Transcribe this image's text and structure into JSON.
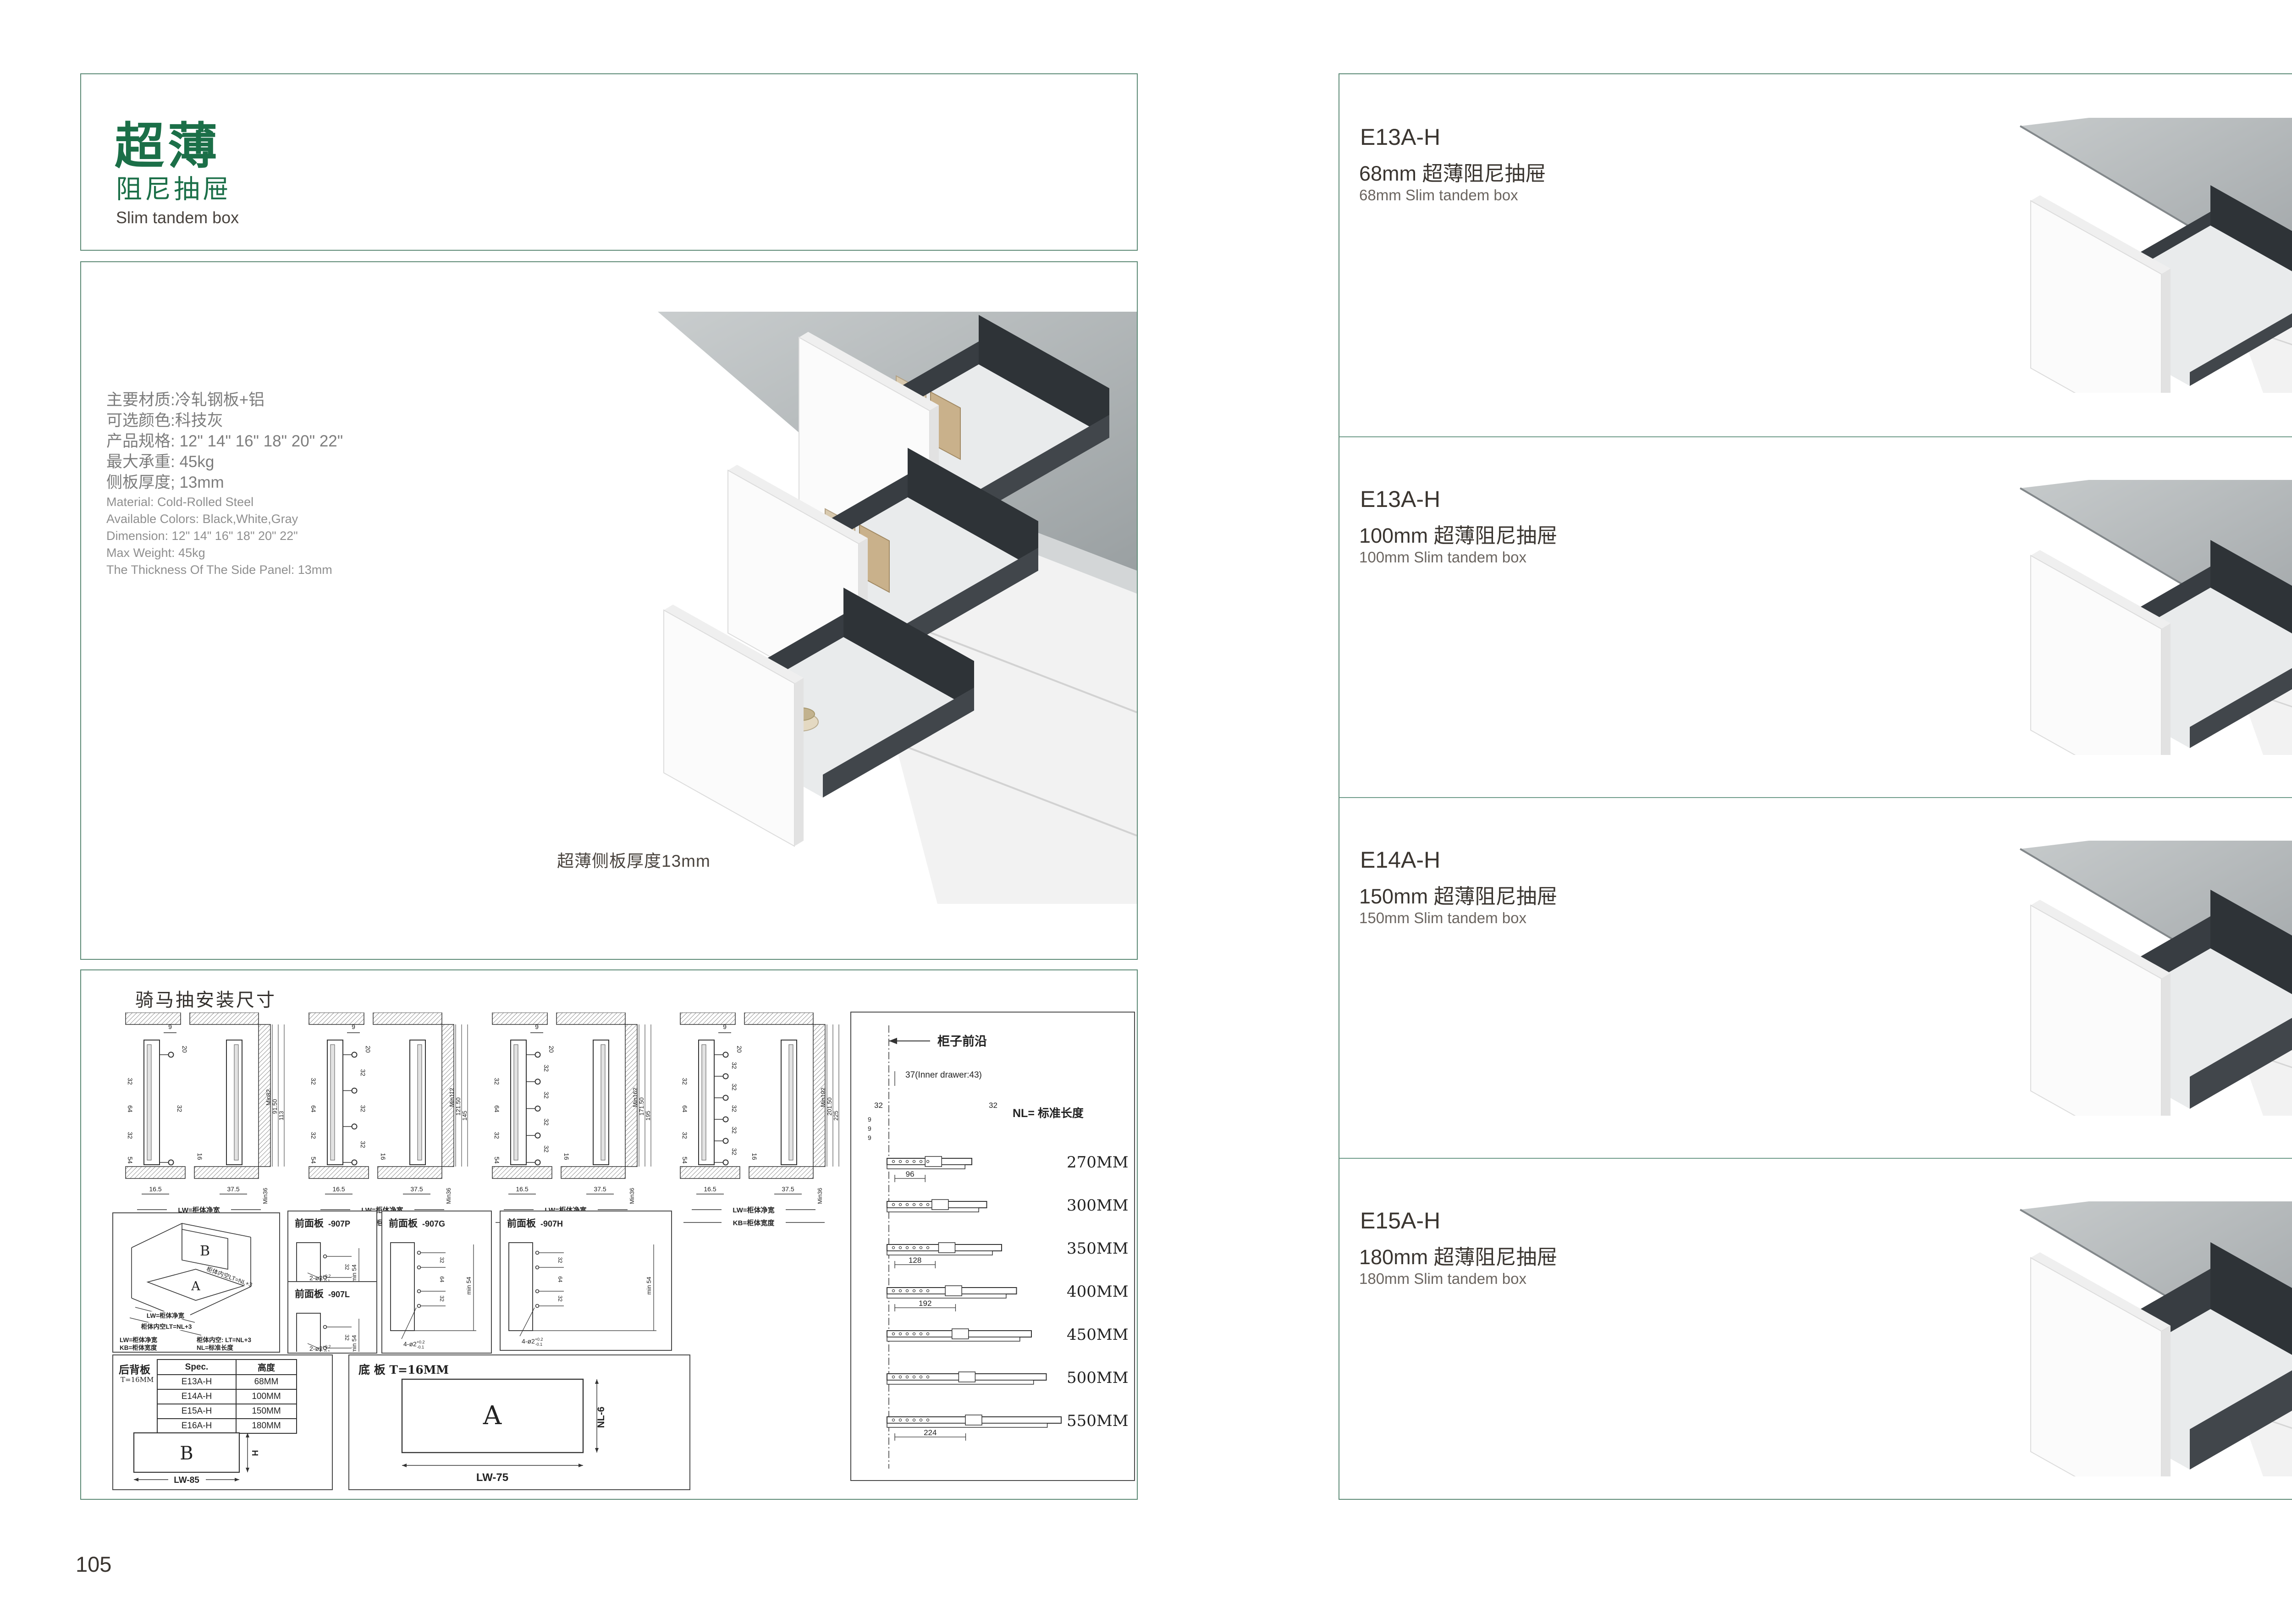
{
  "page": {
    "left_number": "105",
    "right_number": "106"
  },
  "colors": {
    "accent_green": "#1b6f48",
    "frame_teal": "#5d8a76",
    "divider_teal": "#6f9c8a",
    "drawer_dark": "#383d42",
    "counter_gray": "#b4b8ba"
  },
  "left_page": {
    "title": {
      "cn_main": "超薄",
      "cn_sub": "阻尼抽屉",
      "en": "Slim tandem box"
    },
    "specs_cn": [
      "主要材质:冷轧钢板+铝",
      "可选颜色:科技灰",
      "产品规格: 12\" 14\" 16\" 18\" 20\" 22\"",
      "最大承重: 45kg",
      "侧板厚度; 13mm"
    ],
    "specs_en": [
      "Material: Cold-Rolled Steel",
      "Available Colors: Black,White,Gray",
      "Dimension: 12\" 14\" 16\" 18\" 20\" 22\"",
      "Max Weight: 45kg",
      "The Thickness Of The Side Panel: 13mm"
    ],
    "photo_caption": "超薄侧板厚度13mm"
  },
  "drawings": {
    "title": "骑马抽安装尺寸",
    "dims": {
      "d9": "9",
      "d20": "20",
      "d32": "32",
      "d64": "64",
      "d16": "16",
      "d54": "54",
      "d16_5": "16.5",
      "d37_5": "37.5",
      "min36": "Min36"
    },
    "lw_label": "LW=柜体净宽",
    "kb_label": "KB=柜体宽度",
    "cross_sections": [
      {
        "heights": [
          "Min82",
          "91.50",
          "113"
        ],
        "holes": 2
      },
      {
        "heights": [
          "Min112",
          "121.50",
          "145"
        ],
        "holes": 4
      },
      {
        "heights": [
          "Min162",
          "171.50",
          "195"
        ],
        "holes": 5
      },
      {
        "heights": [
          "Min192",
          "201.50",
          "225"
        ],
        "holes": 6
      }
    ],
    "nl_panel": {
      "cabinet_front": "柜子前沿",
      "inner_drawer": "37(Inner drawer:43)",
      "side_dim_32": "32",
      "side_dim_9": "9",
      "nl_label": "NL= 标准长度",
      "lengths": [
        "270MM",
        "300MM",
        "350MM",
        "400MM",
        "450MM",
        "500MM",
        "550MM"
      ],
      "pitch_dims": [
        "96",
        "128",
        "192",
        "224"
      ]
    },
    "isometric": {
      "a": "A",
      "b": "B",
      "lt_diag": "柜体内空LT=NL+3",
      "notes_col1": [
        "LW=柜体净宽",
        "KB=柜体宽度"
      ],
      "notes_col2": [
        "柜体内空: LT=NL+3",
        "NL=标准长度"
      ]
    },
    "front_panels": {
      "title": "前面板",
      "min54": "min 54",
      "tol_plus": "+0.2",
      "tol_minus": "-0.1",
      "variants": [
        {
          "code": "-907P",
          "qty": "2-ø2",
          "holes": 2
        },
        {
          "code": "-907L",
          "qty": "2-ø2",
          "holes": 2
        },
        {
          "code": "-907G",
          "qty": "4-ø2",
          "holes": 4
        },
        {
          "code": "-907H",
          "qty": "4-ø2",
          "holes": 4
        }
      ]
    },
    "back_panel": {
      "name": "后背板",
      "thickness": "T=16MM",
      "table_headers": [
        "Spec.",
        "高度"
      ],
      "table_rows": [
        [
          "E13A-H",
          "68MM"
        ],
        [
          "E14A-H",
          "100MM"
        ],
        [
          "E15A-H",
          "150MM"
        ],
        [
          "E16A-H",
          "180MM"
        ]
      ],
      "b": "B",
      "h": "H",
      "width": "LW-85"
    },
    "bottom_panel": {
      "title": "底 板 T=16MM",
      "a": "A",
      "depth": "NL-6",
      "width": "LW-75"
    }
  },
  "right_page": {
    "products": [
      {
        "model": "E13A-H",
        "title_cn": "68mm 超薄阻尼抽屉",
        "title_en": "68mm Slim tandem box"
      },
      {
        "model": "E13A-H",
        "title_cn": "100mm 超薄阻尼抽屉",
        "title_en": "100mm Slim tandem box"
      },
      {
        "model": "E14A-H",
        "title_cn": "150mm 超薄阻尼抽屉",
        "title_en": "150mm Slim tandem box"
      },
      {
        "model": "E15A-H",
        "title_cn": "180mm 超薄阻尼抽屉",
        "title_en": "180mm Slim tandem box"
      }
    ]
  }
}
